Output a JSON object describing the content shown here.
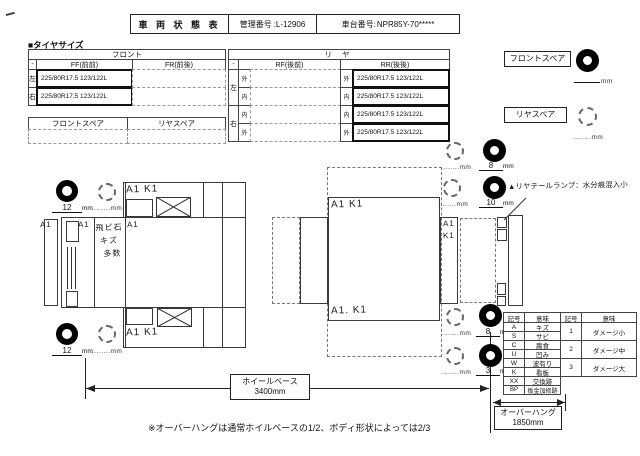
{
  "header": {
    "title": "車 両 状 態 表",
    "mgmt_label": "管理番号",
    "mgmt_value": ":L-12906",
    "chassis_label": "車台番号:",
    "chassis_value": "NPR85Y-70*****"
  },
  "tires": {
    "section_title": "■タイヤサイズ",
    "front": {
      "header": "フロント",
      "dash": "-",
      "ff": "FF(前前)",
      "fr": "FR(前後)",
      "left": "左",
      "right": "右",
      "ff_left": "225/80R17.5 123/122L",
      "ff_right": "225/80R17.5 123/122L"
    },
    "spare_row": {
      "front": "フロントスペア",
      "rear": "リヤスペア"
    },
    "rear": {
      "header": "リ ヤ",
      "dash": "-",
      "rf": "RF(後前)",
      "rr": "RR(後後)",
      "left": "左",
      "right": "右",
      "rows": [
        {
          "pos": "外",
          "rr": "225/80R17.5 123/122L"
        },
        {
          "pos": "内",
          "rr": "225/80R17.5 123/122L"
        },
        {
          "pos": "内",
          "rr": "225/80R17.5 123/122L"
        },
        {
          "pos": "外",
          "rr": "225/80R17.5 123/122L"
        }
      ]
    }
  },
  "spares": {
    "front_label": "フロントスペア",
    "rear_label": "リヤスペア"
  },
  "labels": {
    "mm": "mm",
    "blank": "........"
  },
  "treads": {
    "left_top": "12",
    "left_bottom": "12",
    "r1": "8",
    "r2": "10",
    "r3": "8",
    "r4": "3"
  },
  "hw": {
    "a1": "A1",
    "stone": [
      "飛ビ石",
      "キズ",
      "多数"
    ],
    "alki": "A1 K1",
    "mid_top": "A1 K1",
    "mid_bottom": "A1. K1",
    "strip_a": "A1",
    "strip_k": "K1",
    "taillamp": "▲リヤテールランプ：水分痕混入小"
  },
  "legend": {
    "headers": [
      "記号",
      "意味",
      "記号",
      "意味"
    ],
    "codes": [
      {
        "sym": "A",
        "mean": "キズ"
      },
      {
        "sym": "S",
        "mean": "サビ"
      },
      {
        "sym": "C",
        "mean": "腐食"
      },
      {
        "sym": "U",
        "mean": "凹み"
      },
      {
        "sym": "W",
        "mean": "波有り"
      },
      {
        "sym": "K",
        "mean": "看板"
      },
      {
        "sym": "XX",
        "mean": "交換跡"
      },
      {
        "sym": "BP",
        "mean": "板金加修跡"
      }
    ],
    "levels": [
      {
        "sym": "1",
        "mean": "ダメージ小"
      },
      {
        "sym": "2",
        "mean": "ダメージ中"
      },
      {
        "sym": "3",
        "mean": "ダメージ大"
      }
    ]
  },
  "dims": {
    "wheelbase_label": "ホイールベース",
    "wheelbase_value": "3400mm",
    "overhang_label": "オーバーハング",
    "overhang_value": "1850mm",
    "note": "※オーバーハングは通常ホイルベースの1/2、ボディ形状によっては2/3"
  }
}
